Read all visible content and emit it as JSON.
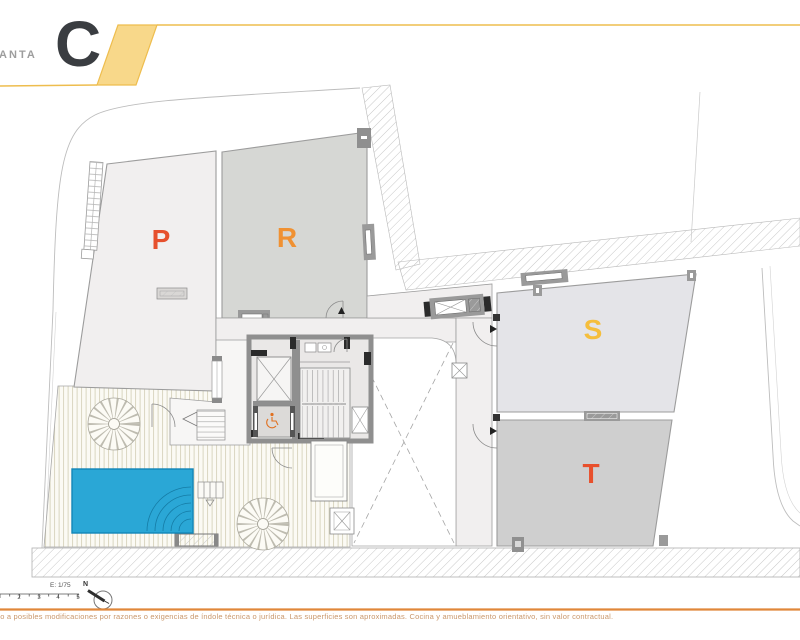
{
  "header": {
    "doc_type_label": "PLANTA",
    "plan_letter": "C"
  },
  "plan": {
    "unit_labels": [
      {
        "id": "P",
        "color": "#e6502d"
      },
      {
        "id": "R",
        "color": "#f09132"
      },
      {
        "id": "S",
        "color": "#f5be3c"
      },
      {
        "id": "T",
        "color": "#e8502c"
      }
    ],
    "pool_color": "#2aa7d6"
  },
  "footer": {
    "scale_label": "E: 1/75",
    "scale_ticks": [
      "2",
      "3",
      "4",
      "5"
    ],
    "north_label": "N",
    "rule_color": "#e0873a",
    "disclaimer": "sto a posibles modificaciones por razones o exigencias de índole técnica o jurídica. Las superficies son aproximadas. Cocina y amueblamiento orientativo, sin valor contractual."
  },
  "accent": {
    "header_yellow_fill": "#f8d88a",
    "header_yellow_line": "#eebd4e"
  }
}
